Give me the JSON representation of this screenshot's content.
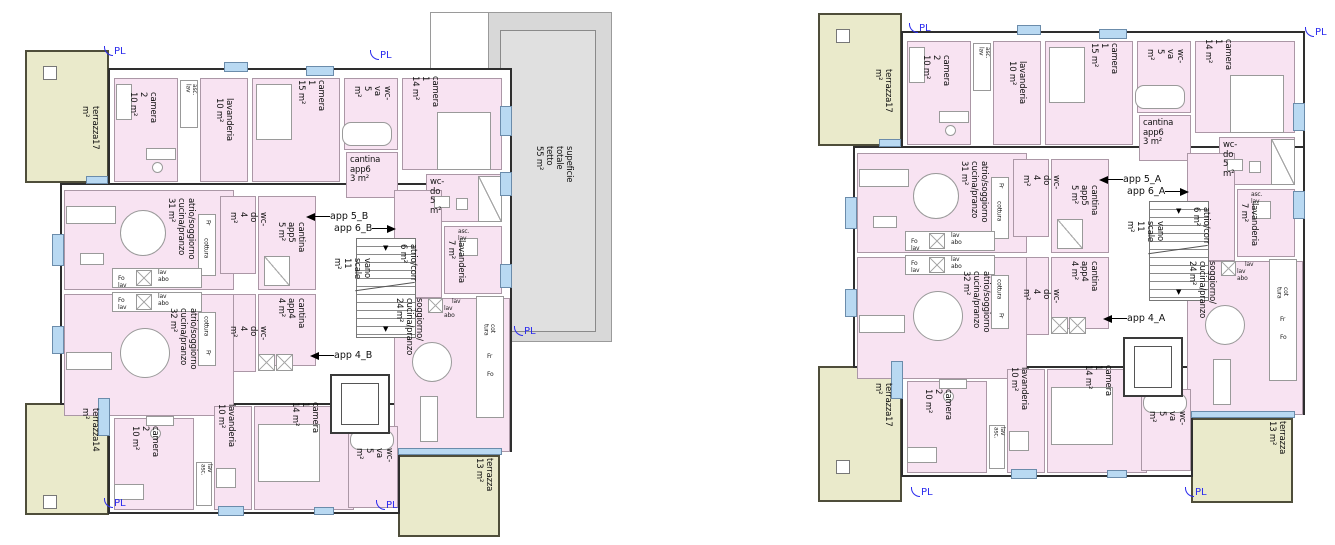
{
  "plans": {
    "b": {
      "terrace_tl": "terrazza17 m²",
      "terrace_bl": "terrazza14 m²",
      "terrace_br": "terrazza\n13 m²",
      "camera2_top": "camera 2\n10 m²",
      "shaft_top": "asc. lav",
      "lavanderia_top": "lavanderia\n10 m²",
      "camera1_15": "camera 1\n15 m²",
      "wcva_top": "wc-va\n5 m²",
      "cantina_app6": "cantina\napp6\n3 m²",
      "camera1_14_top": "camera 1\n14 m²",
      "wcdo_5": "wc-do\n5 m²",
      "shaft_7": "asc. lav",
      "lavanderia_7": "lavanderia\n7 m²",
      "atrio_31": "atrio/soggiorno\ncucina/pranzo\n31 m²",
      "wcdo_4_up": "wc-do\n4 m²",
      "cantina_app5": "cantina\napp5\n5 m²",
      "app5": "app 5_B",
      "app6": "app 6_B",
      "vano_scale": "vano scale\n11 m²",
      "atrio_corr": "atrio/corr\n6 m²",
      "soggiorno_24": "soggiorno/\ncucina/pranzo 24 m²",
      "app4": "app 4_B",
      "cantina_app4": "cantina\napp4\n4 m²",
      "wcdo_4_low": "wc-do\n4 m²",
      "atrio_32": "atrio/soggiorno\ncucina/pranzo\n32 m²",
      "camera2_bot": "camera 2\n10 m²",
      "shaft_bot": "lav  asc.",
      "lavanderia_bot": "lavanderia\n10 m²",
      "camera1_bot": "camera 1\n14 m²",
      "wcva_bot": "wc-va\n5 m²",
      "roof": "supeficie\ntotale tetto\n55 m²",
      "pl": "PL"
    },
    "a": {
      "terrace_tl": "terrazza17 m²",
      "terrace_bl": "terrazza17 m²",
      "terrace_br": "terrazza\n13 m²",
      "camera2_top": "camera 2\n10 m²",
      "shaft_top": "asc. lav",
      "lavanderia_top": "lavanderia\n10 m²",
      "camera1_15": "camera 1\n15 m²",
      "wcva_top": "wc-va\n5 m²",
      "cantina_app6": "cantina\napp6\n3 m²",
      "camera1_14_top": "camera 1\n14 m²",
      "wcdo_5": "wc-do\n5 m²",
      "shaft_7": "asc. lav",
      "lavanderia_7": "lavanderia\n7 m²",
      "atrio_31": "atrio/soggiorno\ncucina/pranzo\n31 m²",
      "wcdo_4_up": "wc-do\n4 m²",
      "cantina_app5": "cantina\napp5\n5 m²",
      "app5": "app 5_A",
      "app6": "app 6_A",
      "vano_scale": "vano scale\n11 m²",
      "atrio_corr": "atrio/corr\n6 m²",
      "soggiorno_24": "soggiorno/\ncucina/pranzo 24 m²",
      "app4": "app 4_A",
      "cantina_app4": "cantina\napp4\n4 m²",
      "wcdo_4_low": "wc-do\n4 m²",
      "atrio_32": "atrio/soggiorno\ncucina/pranzo\n32 m²",
      "camera2_bot": "camera 2\n10 m²",
      "shaft_bot": "lav  asc.",
      "lavanderia_bot": "lavanderia\n10 m²",
      "camera1_bot": "camera 1\n14 m²",
      "wcva_bot": "wc-va\n5 m²",
      "pl": "PL"
    },
    "mini": {
      "fo_lav": "Fo lav",
      "lav_abo": "lav\nabo",
      "cottura": "cottura",
      "fr": "Fr",
      "fo": "Fo",
      "cot_tura": "cot\ntura",
      "lav": "lav",
      "lav_abo_h": "lav  abo"
    }
  },
  "colors": {
    "room_pink": "#f8e3f2",
    "terrace_olive": "#eaeacb",
    "roof_gray": "#d8d8d8",
    "window_blue": "#b9d9f2",
    "pl_blue": "#2b2bee"
  }
}
